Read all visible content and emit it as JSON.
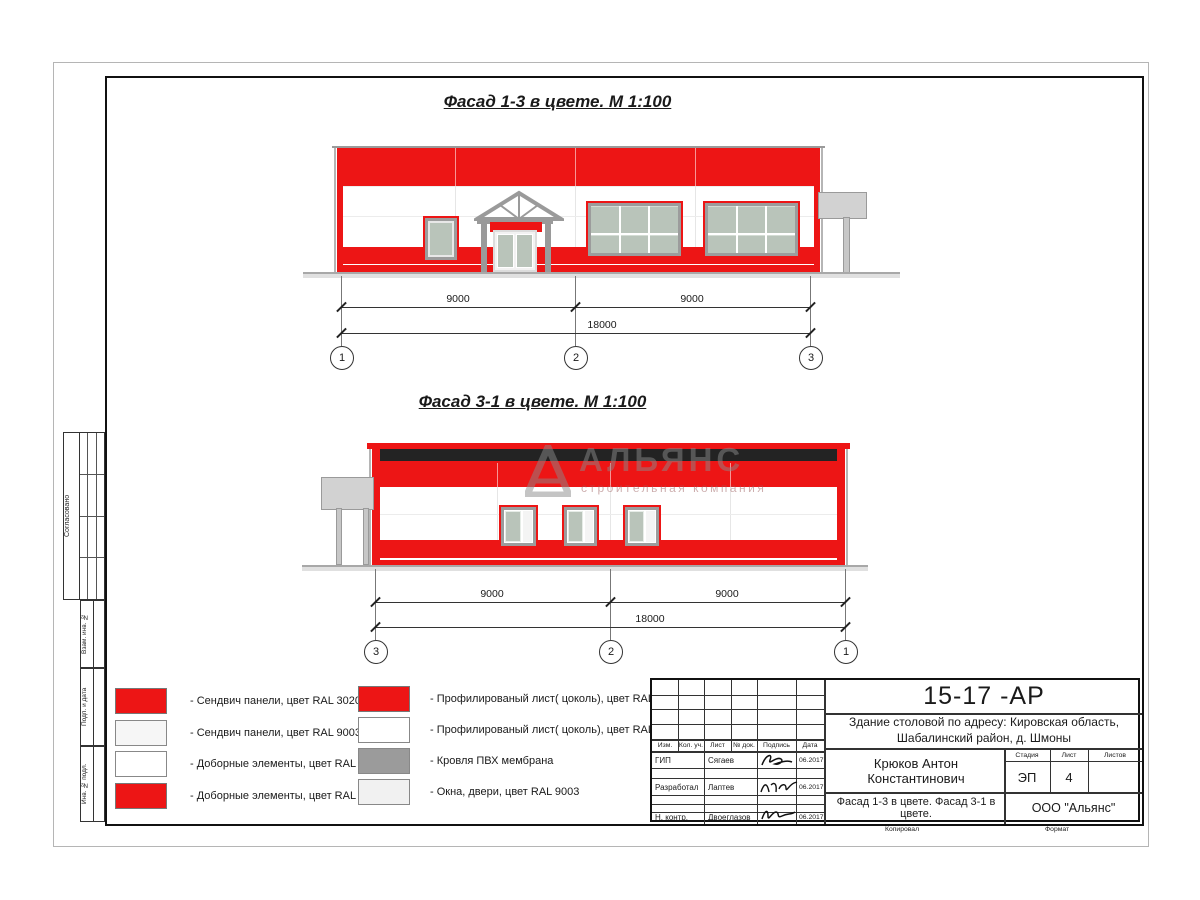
{
  "titles": {
    "facade1": "Фасад 1-3 в цвете.  М 1:100",
    "facade2": "Фасад 3-1 в цвете.  М 1:100"
  },
  "watermark": {
    "title": "АЛЬЯНС",
    "subtitle": "строительная компания"
  },
  "dims": {
    "f1": {
      "left": "9000",
      "right": "9000",
      "total": "18000",
      "axes": [
        "1",
        "2",
        "3"
      ]
    },
    "f2": {
      "left": "9000",
      "right": "9000",
      "total": "18000",
      "axes": [
        "3",
        "2",
        "1"
      ]
    }
  },
  "legend": {
    "left": [
      {
        "swatch": "red",
        "label": "- Сендвич панели, цвет RAL 3020"
      },
      {
        "swatch": "offwhite",
        "label": "- Сендвич панели, цвет RAL 9003"
      },
      {
        "swatch": "white",
        "label": "- Доборные элементы, цвет RAL 9003"
      },
      {
        "swatch": "red",
        "label": "- Доборные элементы, цвет RAL 3020"
      }
    ],
    "right": [
      {
        "swatch": "red",
        "label": "- Профилированый лист( цоколь), цвет RAL 3020"
      },
      {
        "swatch": "white",
        "label": "- Профилированый лист( цоколь), цвет RAL 9003"
      },
      {
        "swatch": "gray",
        "label": "- Кровля ПВХ мембрана"
      },
      {
        "swatch": "lightgray",
        "label": "- Окна, двери, цвет RAL 9003"
      }
    ]
  },
  "titleblock": {
    "doc_number": "15-17 -АР",
    "object": "Здание столовой по адресу: Кировская область, Шабалинский район, д. Шмоны",
    "header_cols": [
      "Изм.",
      "Кол. уч.",
      "Лист",
      "№ док.",
      "Подпись",
      "Дата"
    ],
    "rows": [
      {
        "role": "ГИП",
        "name": "Сягаев",
        "date": "06.2017"
      },
      {
        "role": "Разработал",
        "name": "Лаптев",
        "date": "06.2017"
      },
      {
        "role": "Н. контр.",
        "name": "Двоеглазов",
        "date": "06.2017"
      }
    ],
    "chief": "Крюков Антон Константинович",
    "sheet_title": "Фасад 1-3 в цвете. Фасад 3-1 в цвете.",
    "stage_label": "Стадия",
    "stage_value": "ЭП",
    "sheet_label": "Лист",
    "sheet_value": "4",
    "sheets_label": "Листов",
    "sheets_value": "",
    "company": "ООО \"Альянс\"",
    "copied": "Копировал",
    "format": "Формат"
  },
  "margin": {
    "agreed": "Согласовано",
    "blocks": [
      "Взам. инв. №",
      "Подп. и дата",
      "Инв. № подл."
    ]
  },
  "colors": {
    "ral3020_red": "#ed1515",
    "ral9003_white": "#f6f6f6",
    "pvc_roof_gray": "#9b9b9b",
    "windows_gray": "#f1f1f1",
    "glass": "#b9c4ba"
  }
}
